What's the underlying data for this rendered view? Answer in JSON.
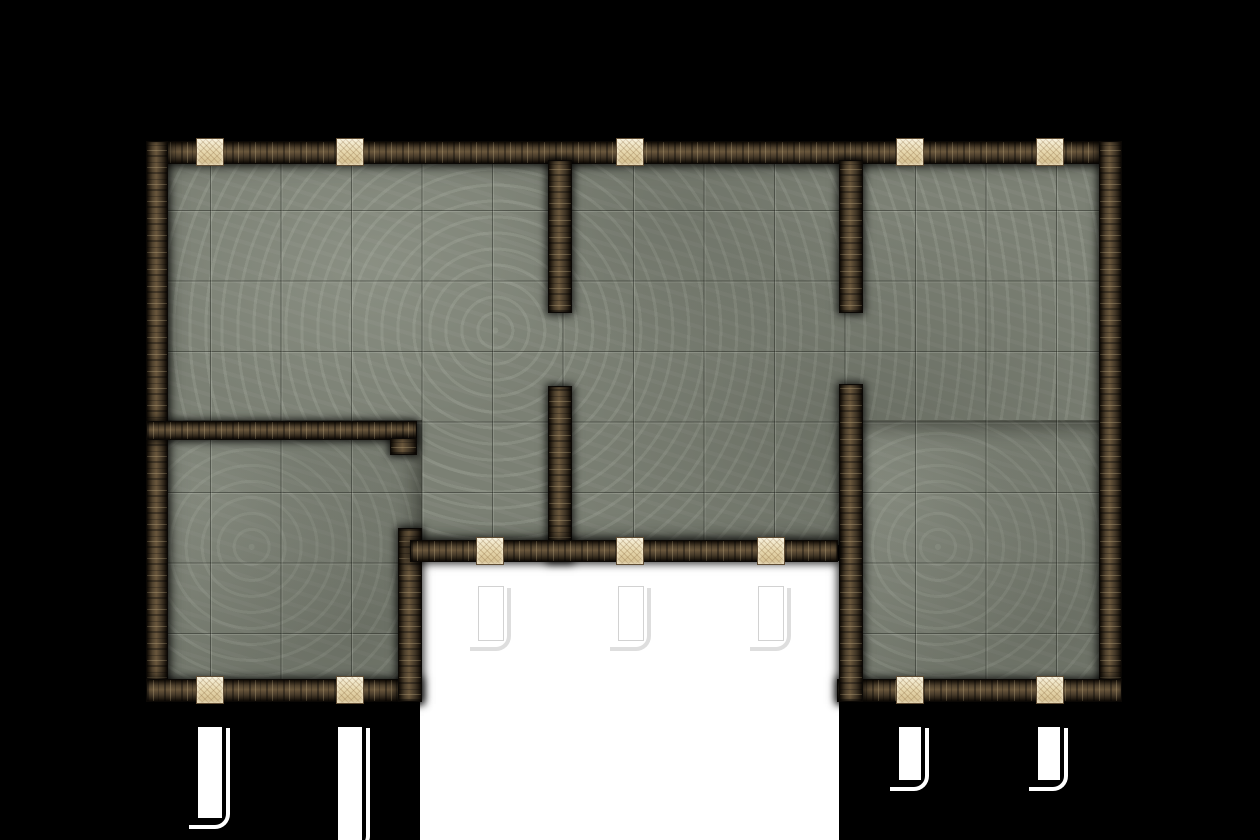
{
  "meta": {
    "description": "Top-down dungeon battle map tile: stone outer walls with interior dividing walls, grey tiled stone floor, tan door tiles set into walls, and white door/exit markers outside the rooms",
    "image_type": "dungeon-battlemap"
  },
  "canvas": {
    "width": 1260,
    "height": 840,
    "background_color": "#000000"
  },
  "palette": {
    "background": "#000000",
    "cutout_white": "#ffffff",
    "floor_base": "#7b8074",
    "floor_light_mottle": "#a9aea1",
    "floor_dark_mottle": "#60645a",
    "tile_line_dark": "#454940",
    "tile_line_light": "#c6cbbb",
    "wall_dark": "#171009",
    "wall_mid": "#51432f",
    "wall_light": "#6a573c",
    "door_fill": "#e6d7b2",
    "door_edge": "#5f4c33",
    "marker_fill": "#ffffff"
  },
  "grid": {
    "tile_size_px": 70.5,
    "line_origin_x": 210,
    "line_origin_y": 210
  },
  "cutouts": [
    {
      "name": "white-exterior-area",
      "x": 420,
      "y": 561,
      "w": 419,
      "h": 279
    }
  ],
  "floors": [
    {
      "name": "floor-upper-rooms",
      "x": 160,
      "y": 155,
      "w": 958,
      "h": 390
    },
    {
      "name": "floor-left-wing-room",
      "x": 160,
      "y": 420,
      "w": 262,
      "h": 282
    },
    {
      "name": "floor-right-wing-room",
      "x": 841,
      "y": 420,
      "w": 277,
      "h": 282
    }
  ],
  "walls": [
    {
      "name": "outer-top-wall",
      "x": 146,
      "y": 141,
      "w": 976,
      "h": 23,
      "dir": "h"
    },
    {
      "name": "outer-left-wall",
      "x": 146,
      "y": 141,
      "w": 22,
      "h": 561,
      "dir": "v"
    },
    {
      "name": "outer-right-wall",
      "x": 1099,
      "y": 141,
      "w": 23,
      "h": 561,
      "dir": "v"
    },
    {
      "name": "left-wing-bottom-wall",
      "x": 146,
      "y": 679,
      "w": 276,
      "h": 23,
      "dir": "h"
    },
    {
      "name": "right-wing-bottom-wall",
      "x": 837,
      "y": 679,
      "w": 285,
      "h": 23,
      "dir": "h"
    },
    {
      "name": "divider-left-upper",
      "x": 548,
      "y": 160,
      "w": 24,
      "h": 153,
      "dir": "v"
    },
    {
      "name": "divider-left-lower",
      "x": 548,
      "y": 386,
      "w": 24,
      "h": 176,
      "dir": "v"
    },
    {
      "name": "divider-right-upper",
      "x": 839,
      "y": 160,
      "w": 24,
      "h": 153,
      "dir": "v"
    },
    {
      "name": "divider-right-lower",
      "x": 839,
      "y": 384,
      "w": 24,
      "h": 318,
      "dir": "v"
    },
    {
      "name": "left-mid-wall",
      "x": 146,
      "y": 421,
      "w": 271,
      "h": 19,
      "dir": "h"
    },
    {
      "name": "left-mid-wall-hook",
      "x": 390,
      "y": 438,
      "w": 27,
      "h": 17,
      "dir": "v"
    },
    {
      "name": "left-wing-right-wall",
      "x": 398,
      "y": 528,
      "w": 24,
      "h": 174,
      "dir": "v"
    },
    {
      "name": "middle-bottom-wall",
      "x": 410,
      "y": 540,
      "w": 428,
      "h": 22,
      "dir": "h"
    }
  ],
  "doors": [
    {
      "name": "door-top-1",
      "x": 196,
      "y": 138,
      "w": 28,
      "h": 28
    },
    {
      "name": "door-top-2",
      "x": 336,
      "y": 138,
      "w": 28,
      "h": 28
    },
    {
      "name": "door-top-3",
      "x": 616,
      "y": 138,
      "w": 28,
      "h": 28
    },
    {
      "name": "door-top-4",
      "x": 896,
      "y": 138,
      "w": 28,
      "h": 28
    },
    {
      "name": "door-top-5",
      "x": 1036,
      "y": 138,
      "w": 28,
      "h": 28
    },
    {
      "name": "door-middle-south-1",
      "x": 476,
      "y": 537,
      "w": 28,
      "h": 28
    },
    {
      "name": "door-middle-south-2",
      "x": 616,
      "y": 537,
      "w": 28,
      "h": 28
    },
    {
      "name": "door-middle-south-3",
      "x": 757,
      "y": 537,
      "w": 28,
      "h": 28
    },
    {
      "name": "door-left-wing-1",
      "x": 196,
      "y": 676,
      "w": 28,
      "h": 28
    },
    {
      "name": "door-left-wing-2",
      "x": 336,
      "y": 676,
      "w": 28,
      "h": 28
    },
    {
      "name": "door-right-wing-1",
      "x": 896,
      "y": 676,
      "w": 28,
      "h": 28
    },
    {
      "name": "door-right-wing-2",
      "x": 1036,
      "y": 676,
      "w": 28,
      "h": 28
    }
  ],
  "markers": [
    {
      "name": "door-marker-left-1",
      "x": 198,
      "y": 727,
      "w": 24,
      "h": 91,
      "bg": "dark"
    },
    {
      "name": "door-marker-left-2",
      "x": 338,
      "y": 727,
      "w": 24,
      "h": 113,
      "bg": "dark"
    },
    {
      "name": "door-marker-middle-1",
      "x": 479,
      "y": 587,
      "w": 24,
      "h": 53,
      "bg": "light"
    },
    {
      "name": "door-marker-middle-2",
      "x": 619,
      "y": 587,
      "w": 24,
      "h": 53,
      "bg": "light"
    },
    {
      "name": "door-marker-middle-3",
      "x": 759,
      "y": 587,
      "w": 24,
      "h": 53,
      "bg": "light"
    },
    {
      "name": "door-marker-right-1",
      "x": 899,
      "y": 727,
      "w": 22,
      "h": 53,
      "bg": "dark"
    },
    {
      "name": "door-marker-right-2",
      "x": 1038,
      "y": 727,
      "w": 22,
      "h": 53,
      "bg": "dark"
    }
  ]
}
